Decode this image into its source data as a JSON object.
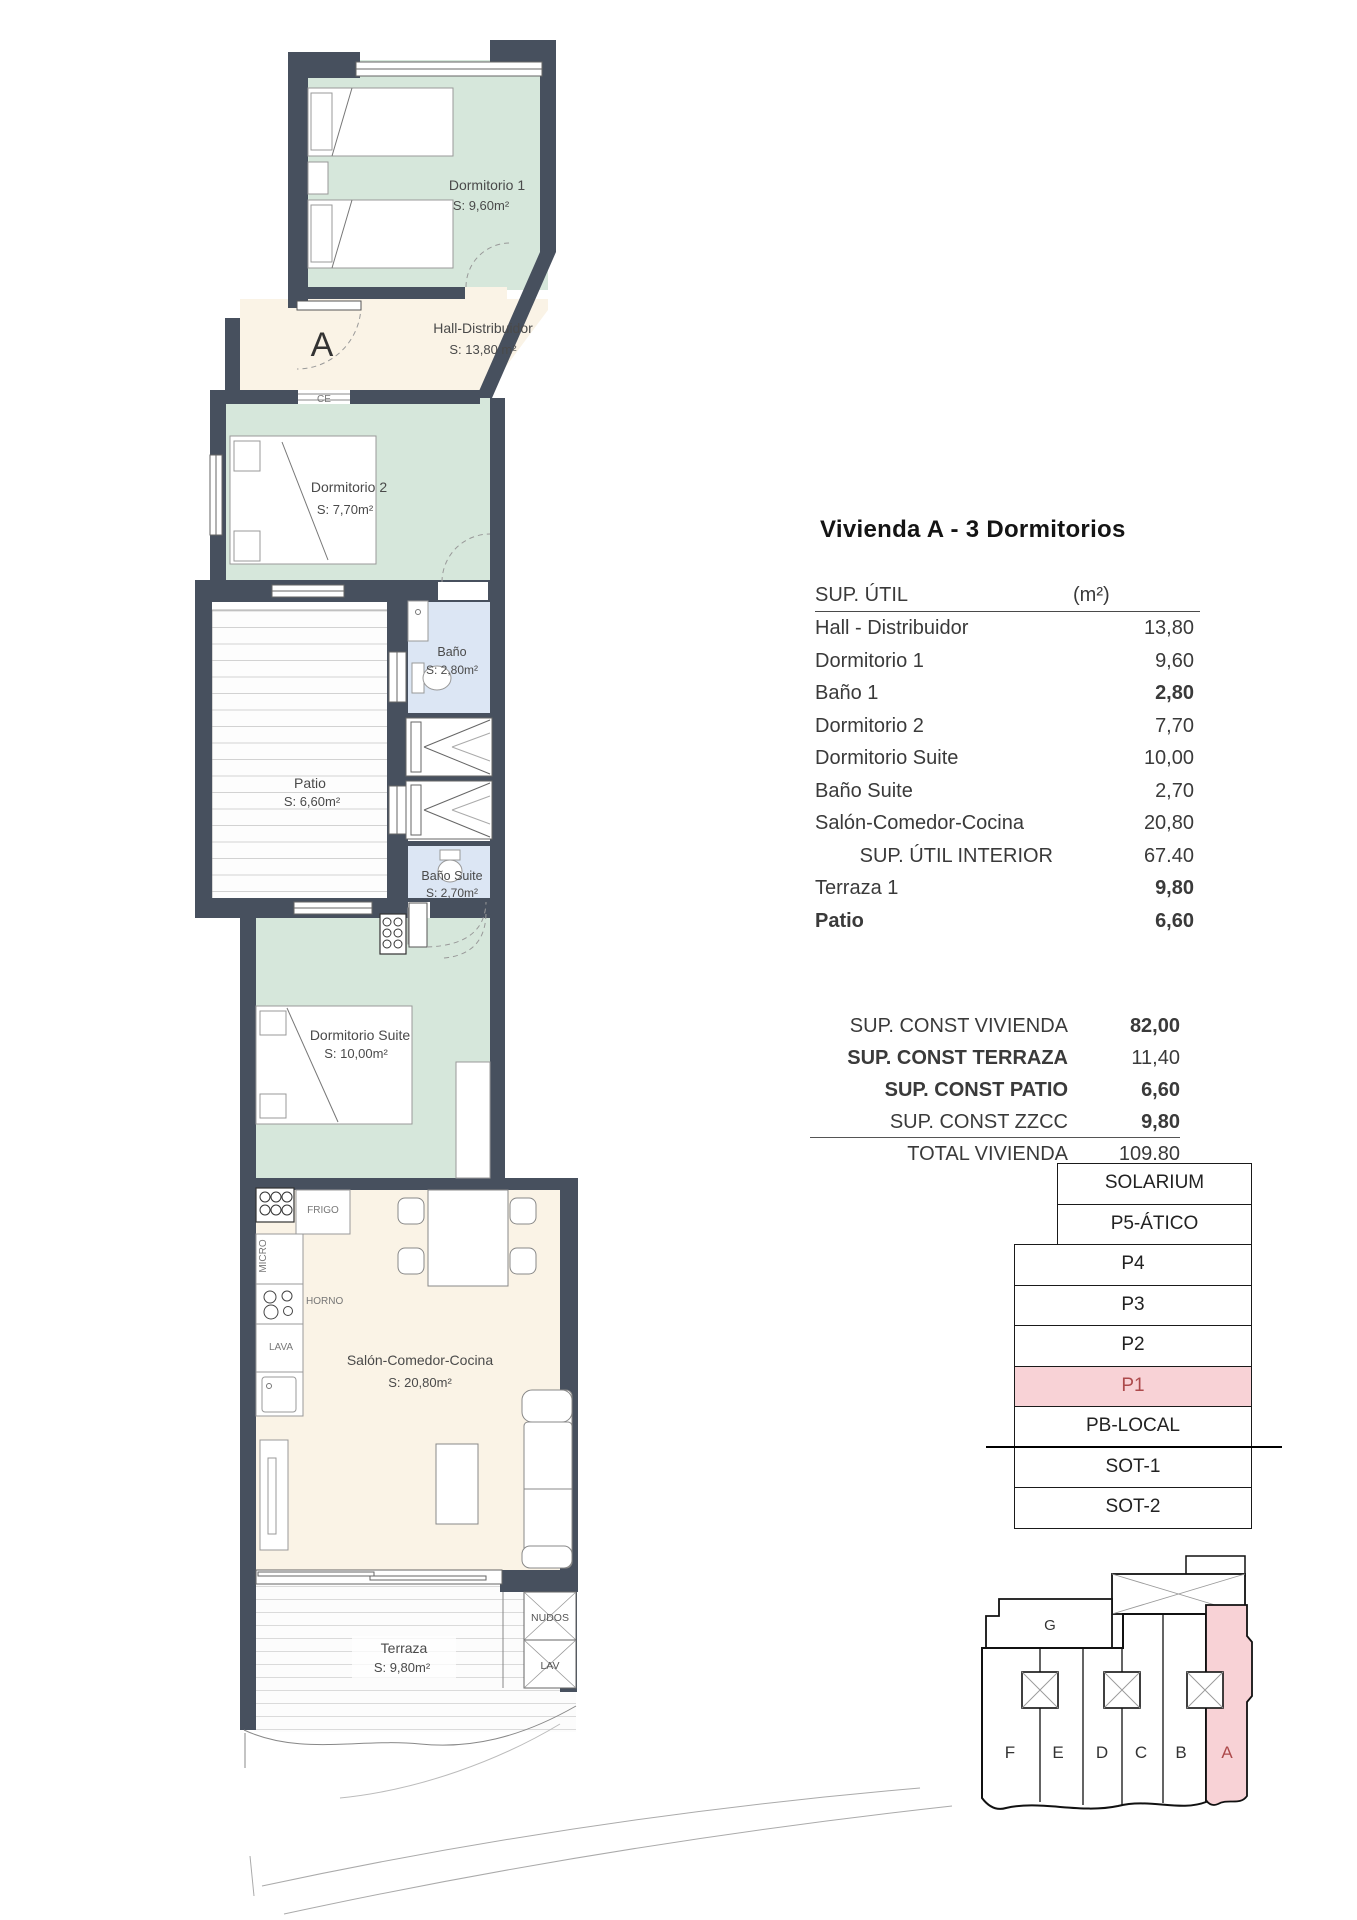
{
  "title": "Vivienda A - 3 Dormitorios",
  "sup_util": {
    "header": "SUP. ÚTIL",
    "unit": "(m²)",
    "rows": [
      {
        "label": "Hall - Distribuidor",
        "value": "13,80"
      },
      {
        "label": "Dormitorio 1",
        "value": "9,60"
      },
      {
        "label": "Baño 1",
        "value": "2,80"
      },
      {
        "label": "Dormitorio 2",
        "value": "7,70"
      },
      {
        "label": "Dormitorio Suite",
        "value": "10,00"
      },
      {
        "label": "Baño Suite",
        "value": "2,70"
      },
      {
        "label": "Salón-Comedor-Cocina",
        "value": "20,80"
      },
      {
        "label": "SUP. ÚTIL INTERIOR",
        "value": "67.40"
      },
      {
        "label": "Terraza 1",
        "value": "9,80"
      },
      {
        "label": "Patio",
        "value": "6,60"
      }
    ]
  },
  "sup_const": {
    "rows": [
      {
        "label": "SUP. CONST VIVIENDA",
        "value": "82,00"
      },
      {
        "label": "SUP. CONST TERRAZA",
        "value": "11,40"
      },
      {
        "label": "SUP. CONST PATIO",
        "value": "6,60"
      },
      {
        "label": "SUP. CONST ZZCC",
        "value": "9,80"
      },
      {
        "label": "TOTAL VIVIENDA",
        "value": "109.80"
      }
    ]
  },
  "floor_stack": {
    "levels": [
      "SOLARIUM",
      "P5-ÁTICO",
      "P4",
      "P3",
      "P2",
      "P1",
      "PB-LOCAL",
      "SOT-1",
      "SOT-2"
    ],
    "highlighted_level": "P1"
  },
  "key_plan": {
    "block_label": "G",
    "units": [
      "F",
      "E",
      "D",
      "C",
      "B",
      "A"
    ],
    "highlighted_unit": "A"
  },
  "plan": {
    "entrance_label": "A",
    "wall_tag": "CE",
    "rooms": [
      {
        "name": "Dormitorio 1",
        "area": "S: 9,60m²"
      },
      {
        "name": "Hall-Distribuidor",
        "area": "S: 13,80 m²"
      },
      {
        "name": "Dormitorio 2",
        "area": "S: 7,70m²"
      },
      {
        "name": "Baño",
        "area": "S: 2,80m²"
      },
      {
        "name": "Patio",
        "area": "S: 6,60m²"
      },
      {
        "name": "Baño Suite",
        "area": "S: 2,70m²"
      },
      {
        "name": "Dormitorio Suite",
        "area": "S: 10,00m²"
      },
      {
        "name": "Salón-Comedor-Cocina",
        "area": "S: 20,80m²"
      },
      {
        "name": "Terraza",
        "area": "S: 9,80m²"
      }
    ],
    "kitchen": {
      "frigo": "FRIGO",
      "micro": "MICRO",
      "horno": "HORNO",
      "lava": "LAVA"
    },
    "utility": {
      "nudos": "NUDOS",
      "lav": "LAV"
    }
  },
  "colors": {
    "wall": "#47505E",
    "bedroom_fill": "#D6E7DB",
    "hall_fill": "#FAF3E6",
    "bath_fill": "#DCE6F4",
    "highlight_fill": "#F8D2D6",
    "highlight_text": "#AD4A4C"
  }
}
